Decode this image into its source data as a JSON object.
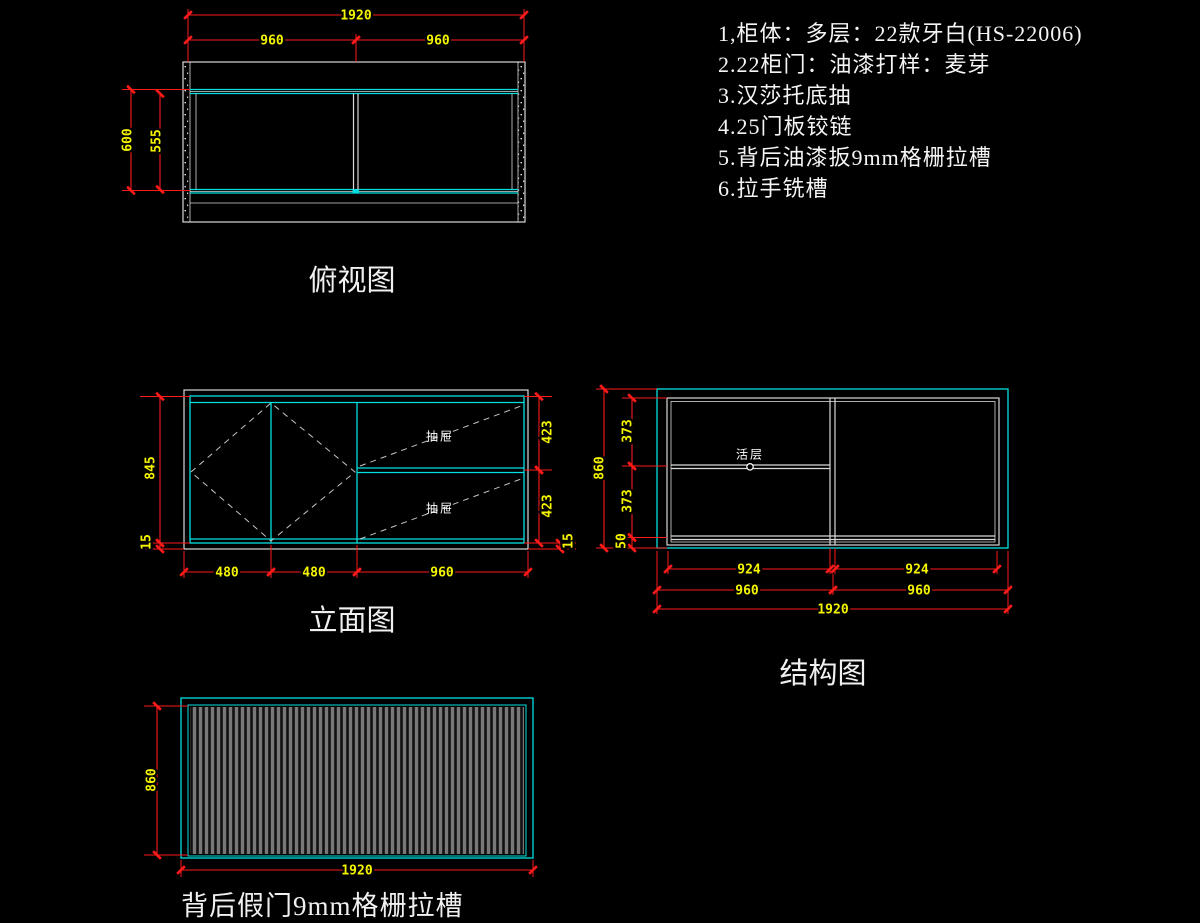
{
  "colors": {
    "background": "#000000",
    "dimension_line": "#ff1a1a",
    "dimension_text": "#f5f500",
    "outline": "#d9d9d9",
    "panel_line": "#00e0e0",
    "note_text": "#f5f5f5",
    "grille": "#787878"
  },
  "notes": {
    "lines": [
      "1,柜体：多层：22款牙白(HS-22006)",
      "2.22柜门：油漆打样：麦芽",
      "3.汉莎托底抽",
      "4.25门板铰链",
      "5.背后油漆扳9mm格栅拉槽",
      "6.拉手铣槽"
    ]
  },
  "top_view": {
    "title": "俯视图",
    "dim_total_width": "1920",
    "dim_left_width": "960",
    "dim_right_width": "960",
    "dim_depth": "600",
    "dim_inner_depth": "555"
  },
  "elevation_view": {
    "title": "立面图",
    "dim_inner_height": "845",
    "dim_bottom_left": "15",
    "dim_drawer_upper": "423",
    "dim_drawer_lower": "423",
    "dim_bottom_right": "15",
    "dim_door_left": "480",
    "dim_door_right": "480",
    "dim_drawer_bay": "960",
    "label_drawer_upper": "抽屉",
    "label_drawer_lower": "抽屉"
  },
  "structure_view": {
    "title": "结构图",
    "dim_height": "860",
    "dim_upper_section": "373",
    "dim_lower_section": "373",
    "dim_plinth": "50",
    "dim_clear_left": "924",
    "dim_clear_right": "924",
    "dim_bay_left": "960",
    "dim_bay_right": "960",
    "dim_total_width": "1920",
    "label_shelf": "活层"
  },
  "back_view": {
    "title": "背后假门9mm格栅拉槽",
    "dim_height": "860",
    "dim_width": "1920"
  }
}
